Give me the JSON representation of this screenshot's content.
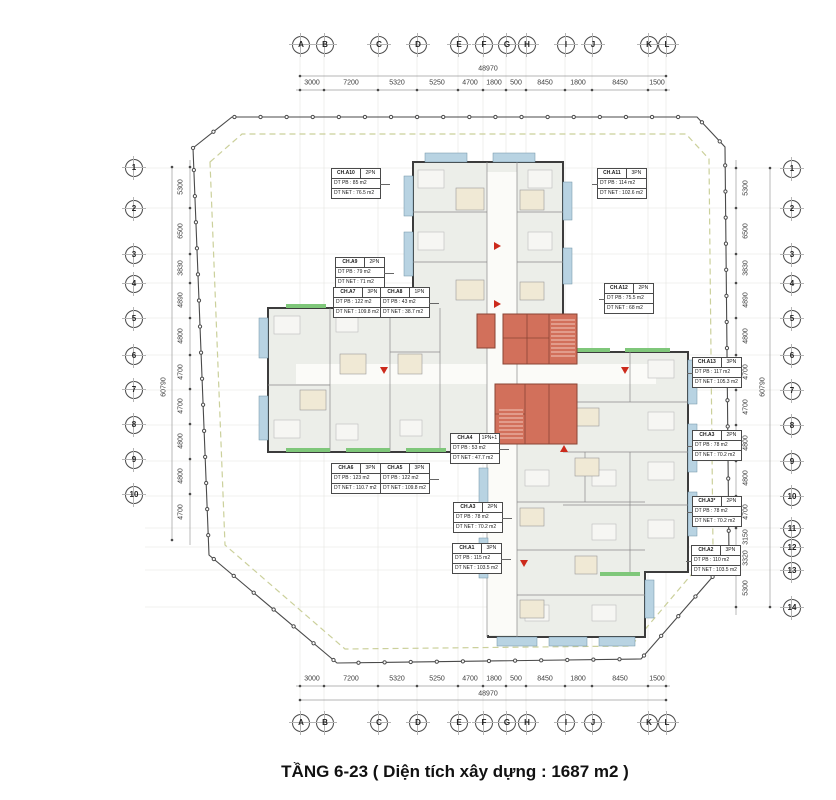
{
  "title": "TẦNG 6-23 ( Diện tích xây dựng : 1687 m2 )",
  "colors": {
    "core": "#d2705b",
    "balcony": "#b8d3e2",
    "greenery": "#7fc77a",
    "floor": "#eceee9",
    "boundary_dash": "#cbd09b"
  },
  "grid": {
    "top_y": 44,
    "bottom_y": 722,
    "left_x": 133,
    "right_x": 791,
    "letters": [
      {
        "label": "A",
        "x": 300
      },
      {
        "label": "B",
        "x": 324
      },
      {
        "label": "C",
        "x": 378
      },
      {
        "label": "D",
        "x": 417
      },
      {
        "label": "E",
        "x": 458
      },
      {
        "label": "F",
        "x": 483
      },
      {
        "label": "G",
        "x": 506
      },
      {
        "label": "H",
        "x": 526
      },
      {
        "label": "I",
        "x": 565
      },
      {
        "label": "J",
        "x": 592
      },
      {
        "label": "K",
        "x": 648
      },
      {
        "label": "L",
        "x": 666
      }
    ],
    "rows_left": [
      {
        "label": "1",
        "y": 167
      },
      {
        "label": "2",
        "y": 208
      },
      {
        "label": "3",
        "y": 254
      },
      {
        "label": "4",
        "y": 283
      },
      {
        "label": "5",
        "y": 318
      },
      {
        "label": "6",
        "y": 355
      },
      {
        "label": "7",
        "y": 389
      },
      {
        "label": "8",
        "y": 424
      },
      {
        "label": "9",
        "y": 459
      },
      {
        "label": "10",
        "y": 494
      }
    ],
    "rows_right": [
      {
        "label": "1",
        "y": 168
      },
      {
        "label": "2",
        "y": 208
      },
      {
        "label": "3",
        "y": 254
      },
      {
        "label": "4",
        "y": 283
      },
      {
        "label": "5",
        "y": 318
      },
      {
        "label": "6",
        "y": 355
      },
      {
        "label": "7",
        "y": 390
      },
      {
        "label": "8",
        "y": 425
      },
      {
        "label": "9",
        "y": 461
      },
      {
        "label": "10",
        "y": 496
      },
      {
        "label": "11",
        "y": 528
      },
      {
        "label": "12",
        "y": 547
      },
      {
        "label": "13",
        "y": 570
      },
      {
        "label": "14",
        "y": 607
      }
    ]
  },
  "dimensions": {
    "x_total": "48970",
    "x_total_x": 488,
    "x_total_top_y": 69,
    "x_total_bottom_y": 694,
    "x_top_y": 83,
    "x_bottom_y": 679,
    "x_segments": [
      {
        "label": "3000",
        "x": 312
      },
      {
        "label": "7200",
        "x": 351
      },
      {
        "label": "5320",
        "x": 397
      },
      {
        "label": "5250",
        "x": 437
      },
      {
        "label": "4700",
        "x": 470
      },
      {
        "label": "1800",
        "x": 494
      },
      {
        "label": "500",
        "x": 516
      },
      {
        "label": "8450",
        "x": 545
      },
      {
        "label": "1800",
        "x": 578
      },
      {
        "label": "8450",
        "x": 620
      },
      {
        "label": "1500",
        "x": 657
      }
    ],
    "y_total": "60790",
    "y_total_y": 387,
    "y_total_left_x": 164,
    "y_total_right_x": 763,
    "y_left_x": 181,
    "y_right_x": 746,
    "y_left_segments": [
      {
        "label": "5300",
        "y": 187
      },
      {
        "label": "6500",
        "y": 231
      },
      {
        "label": "3830",
        "y": 268
      },
      {
        "label": "4890",
        "y": 300
      },
      {
        "label": "4800",
        "y": 336
      },
      {
        "label": "4700",
        "y": 372
      },
      {
        "label": "4700",
        "y": 406
      },
      {
        "label": "4800",
        "y": 441
      },
      {
        "label": "4800",
        "y": 476
      },
      {
        "label": "4700",
        "y": 512
      }
    ],
    "y_right_segments": [
      {
        "label": "5300",
        "y": 188
      },
      {
        "label": "6500",
        "y": 231
      },
      {
        "label": "3830",
        "y": 268
      },
      {
        "label": "4890",
        "y": 300
      },
      {
        "label": "4800",
        "y": 336
      },
      {
        "label": "4700",
        "y": 372
      },
      {
        "label": "4700",
        "y": 407
      },
      {
        "label": "4800",
        "y": 443
      },
      {
        "label": "4800",
        "y": 478
      },
      {
        "label": "4700",
        "y": 512
      },
      {
        "label": "3150",
        "y": 537
      },
      {
        "label": "3320",
        "y": 558
      },
      {
        "label": "5300",
        "y": 588
      }
    ]
  },
  "units": [
    {
      "code": "CH.A10",
      "type": "2PN",
      "pb": "DT PB : 85 m2",
      "net": "DT NET : 76.5 m2",
      "x": 331,
      "y": 168,
      "leader": "right"
    },
    {
      "code": "CH.A11",
      "type": "3PN",
      "pb": "DT PB : 114 m2",
      "net": "DT NET : 102.6 m2",
      "x": 597,
      "y": 168,
      "leader": "left"
    },
    {
      "code": "CH.A9",
      "type": "2PN",
      "pb": "DT PB : 79 m2",
      "net": "DT NET : 71 m2",
      "x": 335,
      "y": 257,
      "leader": "right"
    },
    {
      "code": "CH.A7",
      "type": "3PN",
      "pb": "DT PB : 122 m2",
      "net": "DT NET : 109.8 m2",
      "x": 333,
      "y": 287,
      "leader": "right"
    },
    {
      "code": "CH.A8",
      "type": "1PN",
      "pb": "DT PB : 43 m2",
      "net": "DT NET : 38.7 m2",
      "x": 380,
      "y": 287,
      "leader": "right"
    },
    {
      "code": "CH.A12",
      "type": "2PN",
      "pb": "DT PB : 75.5 m2",
      "net": "DT NET : 68 m2",
      "x": 604,
      "y": 283,
      "leader": "left"
    },
    {
      "code": "CH.A13",
      "type": "3PN",
      "pb": "DT PB : 117 m2",
      "net": "DT NET : 105.3 m2",
      "x": 692,
      "y": 357,
      "leader": "left"
    },
    {
      "code": "CH.A4",
      "type": "1PN+1",
      "pb": "DT PB : 53 m2",
      "net": "DT NET : 47.7 m2",
      "x": 450,
      "y": 433,
      "leader": "right"
    },
    {
      "code": "CH.A6",
      "type": "3PN",
      "pb": "DT PB : 123 m2",
      "net": "DT NET : 110.7 m2",
      "x": 331,
      "y": 463,
      "leader": "right"
    },
    {
      "code": "CH.A5",
      "type": "3PN",
      "pb": "DT PB : 122 m2",
      "net": "DT NET : 109.8 m2",
      "x": 380,
      "y": 463,
      "leader": "right"
    },
    {
      "code": "CH.A3",
      "type": "2PN",
      "pb": "DT PB : 78 m2",
      "net": "DT NET : 70.2 m2",
      "x": 692,
      "y": 430,
      "leader": "left"
    },
    {
      "code": "CH.A3",
      "type": "2PN",
      "pb": "DT PB : 78 m2",
      "net": "DT NET : 70.2 m2",
      "x": 453,
      "y": 502,
      "leader": "right"
    },
    {
      "code": "CH.A3*",
      "type": "2PN",
      "pb": "DT PB : 78 m2",
      "net": "DT NET : 70.2 m2",
      "x": 692,
      "y": 496,
      "leader": "left"
    },
    {
      "code": "CH.A1",
      "type": "3PN",
      "pb": "DT PB : 115 m2",
      "net": "DT NET : 103.5 m2",
      "x": 452,
      "y": 543,
      "leader": "right"
    },
    {
      "code": "CH.A2",
      "type": "3PN",
      "pb": "DT PB : 110 m2",
      "net": "DT NET : 103.5 m2",
      "x": 691,
      "y": 545,
      "leader": "left"
    }
  ]
}
